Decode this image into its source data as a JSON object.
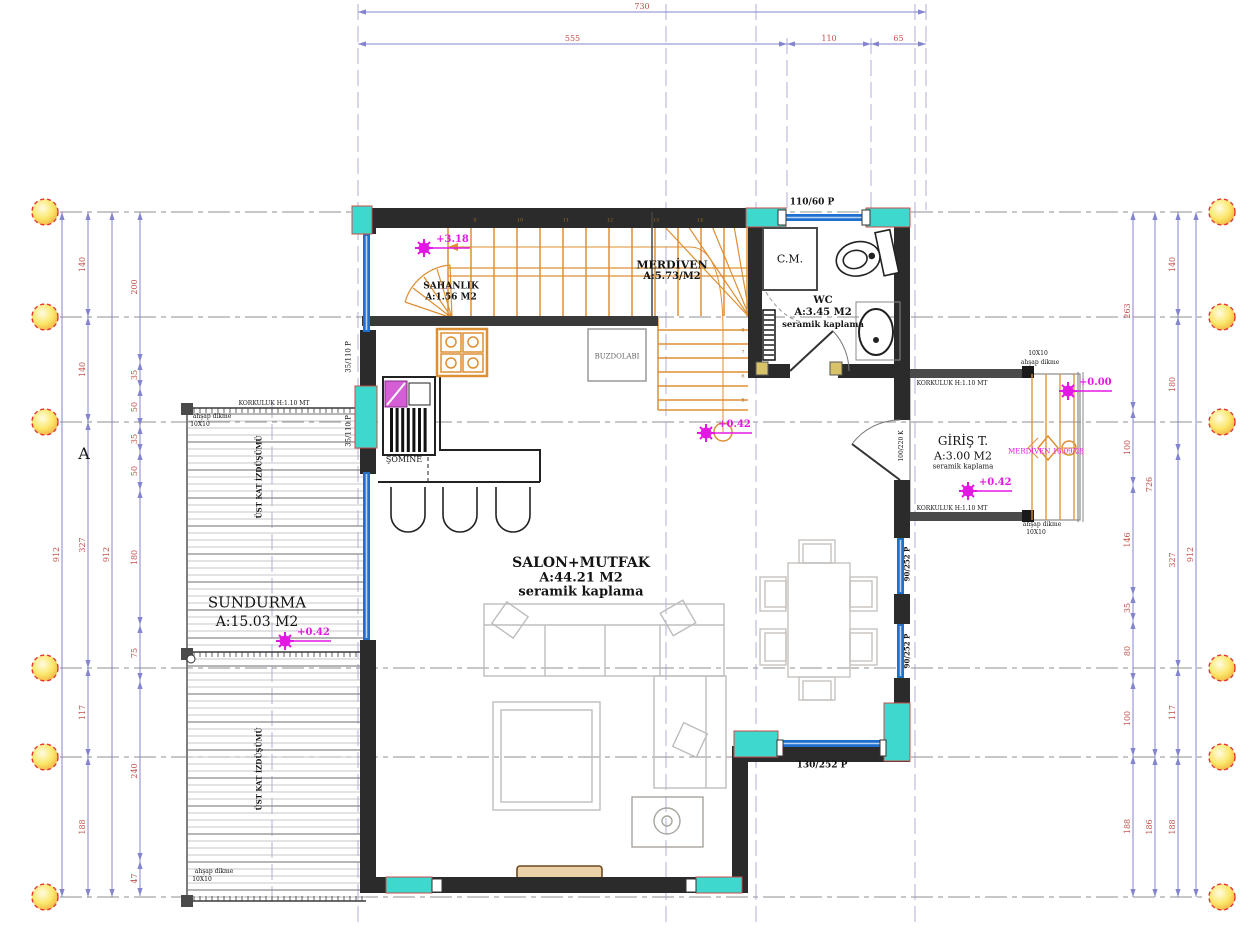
{
  "colors": {
    "wall": "#2b2b2b",
    "wallmid": "#3a3a3a",
    "cyan": "#3fd8ce",
    "cyanstroke": "#c84b4b",
    "blue": "#1e6fd0",
    "dim": "#8585cf",
    "dimtext": "#c2504a",
    "grid": "#8f8f8f",
    "orange": "#dd8f33",
    "magenta": "#e318e3",
    "furn": "#bdbdbd",
    "tan": "#d9c36a"
  },
  "grid": {
    "rows": [
      212,
      317,
      422,
      668,
      757,
      897
    ],
    "circle_r": 13,
    "left_x": 45,
    "right_x": 1222,
    "row_x1": 60,
    "row_x2": 1206,
    "cols": [
      {
        "x": 358,
        "y1": 4,
        "y2": 928
      },
      {
        "x": 666,
        "y1": 4,
        "y2": 928
      },
      {
        "x": 756,
        "y1": 4,
        "y2": 928
      },
      {
        "x": 915,
        "y1": 4,
        "y2": 928
      },
      {
        "x": 926,
        "y1": 4,
        "y2": 210
      },
      {
        "x": 787,
        "y1": 38,
        "y2": 210
      },
      {
        "x": 871,
        "y1": 38,
        "y2": 210
      },
      {
        "x": 272,
        "y1": 402,
        "y2": 908
      }
    ]
  },
  "dimensions": [
    {
      "o": "h",
      "y": 12,
      "t": [
        358,
        926
      ],
      "l": [
        "730"
      ]
    },
    {
      "o": "h",
      "y": 44,
      "t": [
        358,
        787,
        871,
        926
      ],
      "l": [
        "555",
        "110",
        "65"
      ]
    },
    {
      "o": "v",
      "x": 62,
      "t": [
        212,
        897
      ],
      "l": [
        "912"
      ]
    },
    {
      "o": "v",
      "x": 88,
      "t": [
        212,
        317,
        422,
        668,
        757,
        897
      ],
      "l": [
        "140",
        "140",
        "327",
        "117",
        "188"
      ]
    },
    {
      "o": "v",
      "x": 112,
      "t": [
        212,
        897
      ],
      "l": [
        "912"
      ]
    },
    {
      "o": "v",
      "x": 140,
      "t": [
        212,
        362,
        388,
        426,
        452,
        490,
        625,
        681,
        861,
        896
      ],
      "l": [
        "200",
        "35",
        "50",
        "35",
        "50",
        "180",
        "75",
        "240",
        "47"
      ]
    },
    {
      "o": "v",
      "x": 1133,
      "t": [
        212,
        410,
        485,
        595,
        621,
        681,
        756,
        897
      ],
      "l": [
        "263",
        "100",
        "146",
        "35",
        "80",
        "100",
        "188"
      ]
    },
    {
      "o": "v",
      "x": 1155,
      "t": [
        212,
        757,
        897
      ],
      "l": [
        "726",
        "186"
      ]
    },
    {
      "o": "v",
      "x": 1178,
      "t": [
        212,
        317,
        452,
        668,
        757,
        897
      ],
      "l": [
        "140",
        "180",
        "327",
        "117",
        "188"
      ]
    },
    {
      "o": "v",
      "x": 1196,
      "t": [
        212,
        897
      ],
      "l": [
        "912"
      ]
    }
  ],
  "markers": [
    {
      "n": "level-marker-stair",
      "x": 424,
      "y": 248,
      "dx": 46,
      "t": "+3.18"
    },
    {
      "n": "level-marker-salon",
      "x": 706,
      "y": 433,
      "dx": 46,
      "t": "+0.42"
    },
    {
      "n": "level-marker-sundurma",
      "x": 285,
      "y": 641,
      "dx": 46,
      "t": "+0.42"
    },
    {
      "n": "level-marker-giris",
      "x": 968,
      "y": 491,
      "dx": 44,
      "t": "+0.42"
    },
    {
      "n": "level-marker-entry-steps",
      "x": 1068,
      "y": 391,
      "dx": 44,
      "t": "+0.00"
    }
  ],
  "labels": [
    {
      "n": "room-merdiven-title",
      "t": "MERDİVEN",
      "x": 672,
      "y": 265,
      "s": 11,
      "b": 1
    },
    {
      "n": "room-merdiven-area",
      "t": "A:5.73/M2",
      "x": 672,
      "y": 277,
      "s": 10,
      "b": 1
    },
    {
      "n": "room-sahanlik-title",
      "t": "SAHANLIK",
      "x": 451,
      "y": 287,
      "s": 9,
      "b": 1
    },
    {
      "n": "room-sahanlik-area",
      "t": "A:1.56 M2",
      "x": 451,
      "y": 298,
      "s": 9,
      "b": 1
    },
    {
      "n": "closet-cm-label",
      "t": "C.M.",
      "x": 790,
      "y": 259,
      "s": 11
    },
    {
      "n": "room-wc-title",
      "t": "WC",
      "x": 823,
      "y": 301,
      "s": 10,
      "b": 1
    },
    {
      "n": "room-wc-area",
      "t": "A:3.45 M2",
      "x": 823,
      "y": 313,
      "s": 10,
      "b": 1
    },
    {
      "n": "room-wc-floor",
      "t": "seramik kaplama",
      "x": 823,
      "y": 325,
      "s": 8.5,
      "b": 1
    },
    {
      "n": "fridge-label",
      "t": "BUZDOLABI",
      "x": 617,
      "y": 357,
      "s": 7,
      "c": "#666666"
    },
    {
      "n": "fireplace-label",
      "t": "ŞÖMİNE",
      "x": 404,
      "y": 460,
      "s": 8
    },
    {
      "n": "room-salon-title",
      "t": "SALON+MUTFAK",
      "x": 581,
      "y": 563,
      "s": 14,
      "b": 1
    },
    {
      "n": "room-salon-area",
      "t": "A:44.21 M2",
      "x": 581,
      "y": 578,
      "s": 13,
      "b": 1
    },
    {
      "n": "room-salon-floor",
      "t": "seramik kaplama",
      "x": 581,
      "y": 592,
      "s": 13,
      "b": 1
    },
    {
      "n": "room-sundurma-title",
      "t": "SUNDURMA",
      "x": 257,
      "y": 603,
      "s": 15
    },
    {
      "n": "room-sundurma-area",
      "t": "A:15.03 M2",
      "x": 257,
      "y": 622,
      "s": 14
    },
    {
      "n": "room-giris-title",
      "t": "GİRİŞ T.",
      "x": 963,
      "y": 441,
      "s": 12
    },
    {
      "n": "room-giris-area",
      "t": "A:3.00 M2",
      "x": 963,
      "y": 456,
      "s": 11
    },
    {
      "n": "room-giris-floor",
      "t": "seramik kaplama",
      "x": 963,
      "y": 467,
      "s": 7
    },
    {
      "n": "window-code-top",
      "t": "110/60 P",
      "x": 812,
      "y": 203,
      "s": 9,
      "b": 1
    },
    {
      "n": "window-code-bottom",
      "t": "130/252 P",
      "x": 822,
      "y": 766,
      "s": 9,
      "b": 1
    },
    {
      "n": "window-code-right-1",
      "t": "90/252 P",
      "x": 907,
      "y": 564,
      "s": 7,
      "r": -90,
      "b": 1
    },
    {
      "n": "window-code-right-2",
      "t": "90/252 P",
      "x": 907,
      "y": 651,
      "s": 7,
      "r": -90,
      "b": 1
    },
    {
      "n": "window-code-left-1",
      "t": "35/110 P",
      "x": 349,
      "y": 357,
      "s": 7,
      "r": -90
    },
    {
      "n": "window-code-left-2",
      "t": "35/110 P",
      "x": 349,
      "y": 431,
      "s": 7,
      "r": -90
    },
    {
      "n": "door-code-entry",
      "t": "100/220 K",
      "x": 902,
      "y": 446,
      "s": 6,
      "r": -90
    },
    {
      "n": "entry-stair-note",
      "t": "MERDİVEN 16.09/28",
      "x": 1046,
      "y": 452,
      "s": 7,
      "c": "#e318e3"
    },
    {
      "n": "railing-note-1",
      "t": "KORKULUK H:1.10 MT",
      "x": 274,
      "y": 404,
      "s": 6
    },
    {
      "n": "railing-note-2",
      "t": "KORKULUK H:1.10 MT",
      "x": 952,
      "y": 384,
      "s": 6
    },
    {
      "n": "railing-note-3",
      "t": "KORKULUK H:1.10 MT",
      "x": 952,
      "y": 509,
      "s": 6
    },
    {
      "n": "post-note-1a",
      "t": "ahşap dikme",
      "x": 212,
      "y": 417,
      "s": 6
    },
    {
      "n": "post-note-1b",
      "t": "10X10",
      "x": 200,
      "y": 425,
      "s": 6
    },
    {
      "n": "post-note-2a",
      "t": "ahşap dikme",
      "x": 214,
      "y": 872,
      "s": 6
    },
    {
      "n": "post-note-2b",
      "t": "10X10",
      "x": 202,
      "y": 880,
      "s": 6
    },
    {
      "n": "post-note-3a",
      "t": "10X10",
      "x": 1038,
      "y": 354,
      "s": 6
    },
    {
      "n": "post-note-3b",
      "t": "ahşap dikme",
      "x": 1040,
      "y": 363,
      "s": 6
    },
    {
      "n": "post-note-4a",
      "t": "ahşap dikme",
      "x": 1042,
      "y": 525,
      "s": 6
    },
    {
      "n": "post-note-4b",
      "t": "10X10",
      "x": 1036,
      "y": 533,
      "s": 6
    },
    {
      "n": "upper-floor-note-1",
      "t": "ÜST KAT İZDÜŞÜMÜ",
      "x": 259,
      "y": 477,
      "s": 7,
      "r": -90,
      "b": 1
    },
    {
      "n": "upper-floor-note-2",
      "t": "ÜST KAT İZDÜŞÜMÜ",
      "x": 259,
      "y": 769,
      "s": 7,
      "r": -90,
      "b": 1
    },
    {
      "n": "section-mark-a",
      "t": "A",
      "x": 84,
      "y": 454,
      "s": 16
    },
    {
      "n": "tread-num",
      "t": "9",
      "x": 475,
      "y": 221,
      "s": 5,
      "c": "#9a6a20"
    },
    {
      "n": "tread-num",
      "t": "10",
      "x": 520,
      "y": 221,
      "s": 5,
      "c": "#9a6a20"
    },
    {
      "n": "tread-num",
      "t": "11",
      "x": 566,
      "y": 221,
      "s": 5,
      "c": "#9a6a20"
    },
    {
      "n": "tread-num",
      "t": "12",
      "x": 610,
      "y": 221,
      "s": 5,
      "c": "#9a6a20"
    },
    {
      "n": "tread-num",
      "t": "13",
      "x": 656,
      "y": 221,
      "s": 5,
      "c": "#9a6a20"
    },
    {
      "n": "tread-num",
      "t": "14",
      "x": 700,
      "y": 221,
      "s": 5,
      "c": "#9a6a20"
    },
    {
      "n": "tread-num",
      "t": "8",
      "x": 743,
      "y": 331,
      "s": 5,
      "c": "#9a6a20"
    },
    {
      "n": "tread-num",
      "t": "7",
      "x": 743,
      "y": 353,
      "s": 5,
      "c": "#9a6a20"
    },
    {
      "n": "tread-num",
      "t": "6",
      "x": 743,
      "y": 377,
      "s": 5,
      "c": "#9a6a20"
    },
    {
      "n": "tread-num",
      "t": "5",
      "x": 743,
      "y": 401,
      "s": 5,
      "c": "#9a6a20"
    }
  ]
}
